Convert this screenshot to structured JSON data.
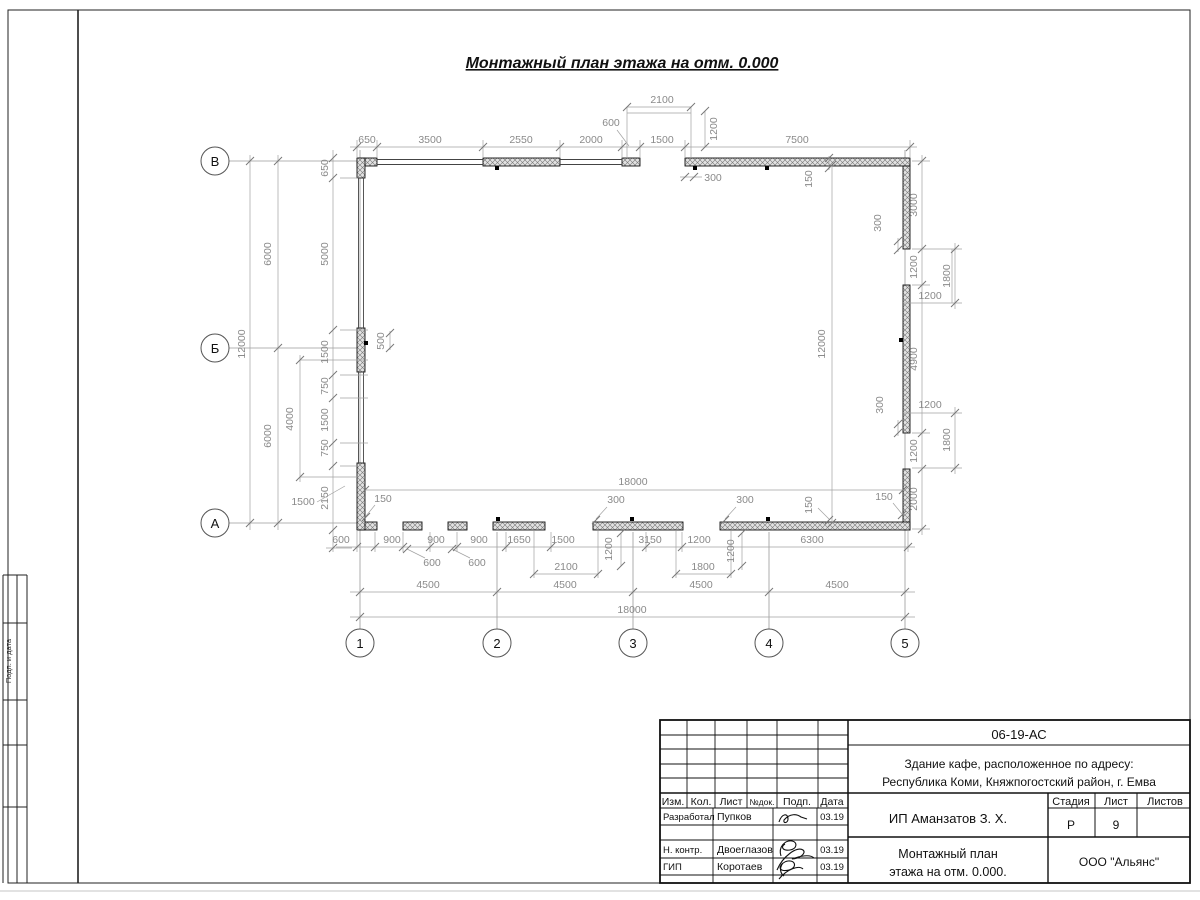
{
  "sheet": {
    "title": "Монтажный план этажа на отм. 0.000"
  },
  "axes": {
    "rows": [
      "В",
      "Б",
      "А"
    ],
    "cols": [
      "1",
      "2",
      "3",
      "4",
      "5"
    ]
  },
  "dims": {
    "top_chain": [
      "650",
      "3500",
      "2550",
      "2000",
      "1500",
      "7500"
    ],
    "top_upper": [
      "600",
      "2100",
      "1200"
    ],
    "top_inner": [
      "300",
      "150"
    ],
    "left_outer": [
      "12000",
      "6000",
      "6000"
    ],
    "left_chain": [
      "650",
      "5000",
      "1500",
      "750",
      "1500",
      "750",
      "2150"
    ],
    "left_misc": [
      "4000",
      "500",
      "1500"
    ],
    "center": [
      "12000",
      "18000"
    ],
    "bottom_chain": [
      "600",
      "900",
      "900",
      "900",
      "1650",
      "1500",
      "3150",
      "1200",
      "6300"
    ],
    "bottom_leaders": [
      "600",
      "600",
      "150",
      "300",
      "300",
      "150",
      "150"
    ],
    "bottom_row2": [
      "2100",
      "1200",
      "1800",
      "1200"
    ],
    "bottom_row3": [
      "4500",
      "4500",
      "4500",
      "4500"
    ],
    "bottom_row4": "18000",
    "right_chain": [
      "3000",
      "1200",
      "4900",
      "1200",
      "2000"
    ],
    "right_aux": [
      "1800",
      "1800",
      "1200",
      "1200",
      "300",
      "300"
    ]
  },
  "titleblock": {
    "doc_number": "06-19-АС",
    "object_line1": "Здание кафе, расположенное по адресу:",
    "object_line2": "Республика Коми, Княжпогостский район, г. Емва",
    "client": "ИП Аманзатов З. Х.",
    "sheet_title_line1": "Монтажный план",
    "sheet_title_line2": "этажа на отм. 0.000.",
    "company": "ООО \"Альянс\"",
    "stage_label": "Стадия",
    "sheet_label": "Лист",
    "sheets_label": "Листов",
    "stage_value": "Р",
    "sheet_value": "9",
    "header_cols": [
      "Изм.",
      "Кол.",
      "Лист",
      "№док.",
      "Подп.",
      "Дата"
    ],
    "rows": [
      {
        "role": "Разработал",
        "name": "Пупков",
        "date": "03.19"
      },
      {
        "role": "Н. контр.",
        "name": "Двоеглазов",
        "date": "03.19"
      },
      {
        "role": "ГИП",
        "name": "Коротаев",
        "date": "03.19"
      }
    ]
  },
  "frame": {
    "side_label": "Подп. и дата"
  }
}
